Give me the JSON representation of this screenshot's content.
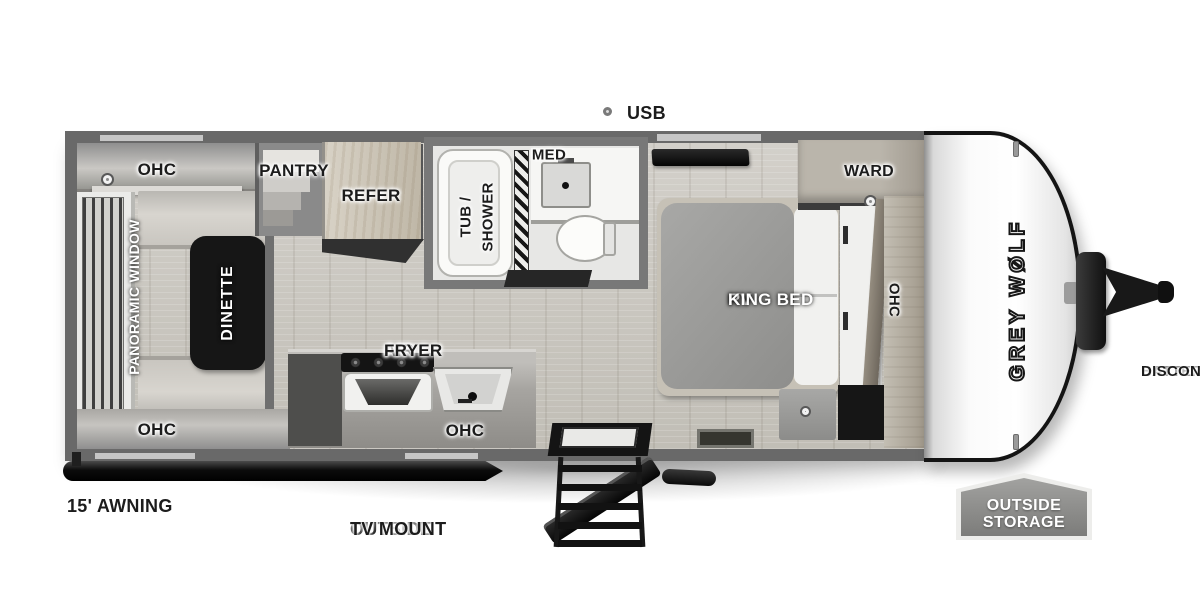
{
  "plan": {
    "brand_logo": "GREY WØLF",
    "labels": {
      "ohc_rear_top": "OHC",
      "ohc_rear_bottom": "OHC",
      "ohc_kitchen": "OHC",
      "ohc_bedroom": "OHC",
      "pantry": "PANTRY",
      "refer": "REFER",
      "med": "MED",
      "tub_shower_line1": "TUB /",
      "tub_shower_line2": "SHOWER",
      "air_fryer_line1": "AIR",
      "air_fryer_line2": "FRYER",
      "dinette": "DINETTE",
      "panoramic_window": "PANORAMIC WINDOW",
      "king_bed_line1": "RV",
      "king_bed_line2": "KING BED",
      "ward": "WARD"
    },
    "callouts": {
      "usb": "USB",
      "awning": "15' AWNING",
      "tv_mount_line1": "OUTSIDE",
      "tv_mount_line2": "TV MOUNT",
      "outside_storage_line1": "OUTSIDE",
      "outside_storage_line2": "STORAGE",
      "battery_line1": "BATTERY",
      "battery_line2": "DISCONNECT"
    },
    "colors": {
      "wall": "#696969",
      "floor": "#cac7c1",
      "accent_dark": "#141414",
      "badge": "#8d8d8d"
    }
  }
}
